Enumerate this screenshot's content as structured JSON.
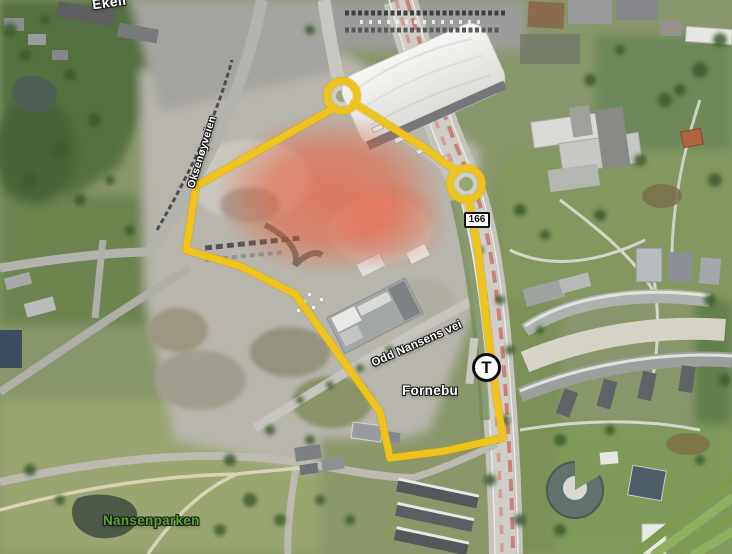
{
  "map": {
    "description": "Aerial satellite view of Fornebu with yellow site boundary and red highlight zone",
    "place_labels": {
      "ekeli": "Ekeli",
      "fornebu": "Fornebu",
      "nansenparken": "Nansenparken"
    },
    "street_labels": {
      "oksenoyveien": "Oksenøyveien",
      "odd_nansens_vei": "Odd Nansens vei"
    },
    "markers": {
      "road_sign": "166",
      "metro": "T"
    },
    "colors": {
      "boundary_yellow": "#eec31b",
      "boundary_yellow_dark": "#c79e08",
      "highlight_red": "#f3532d",
      "park_label_green": "#58a42c",
      "road_sign_bg": "#ffffff"
    }
  }
}
